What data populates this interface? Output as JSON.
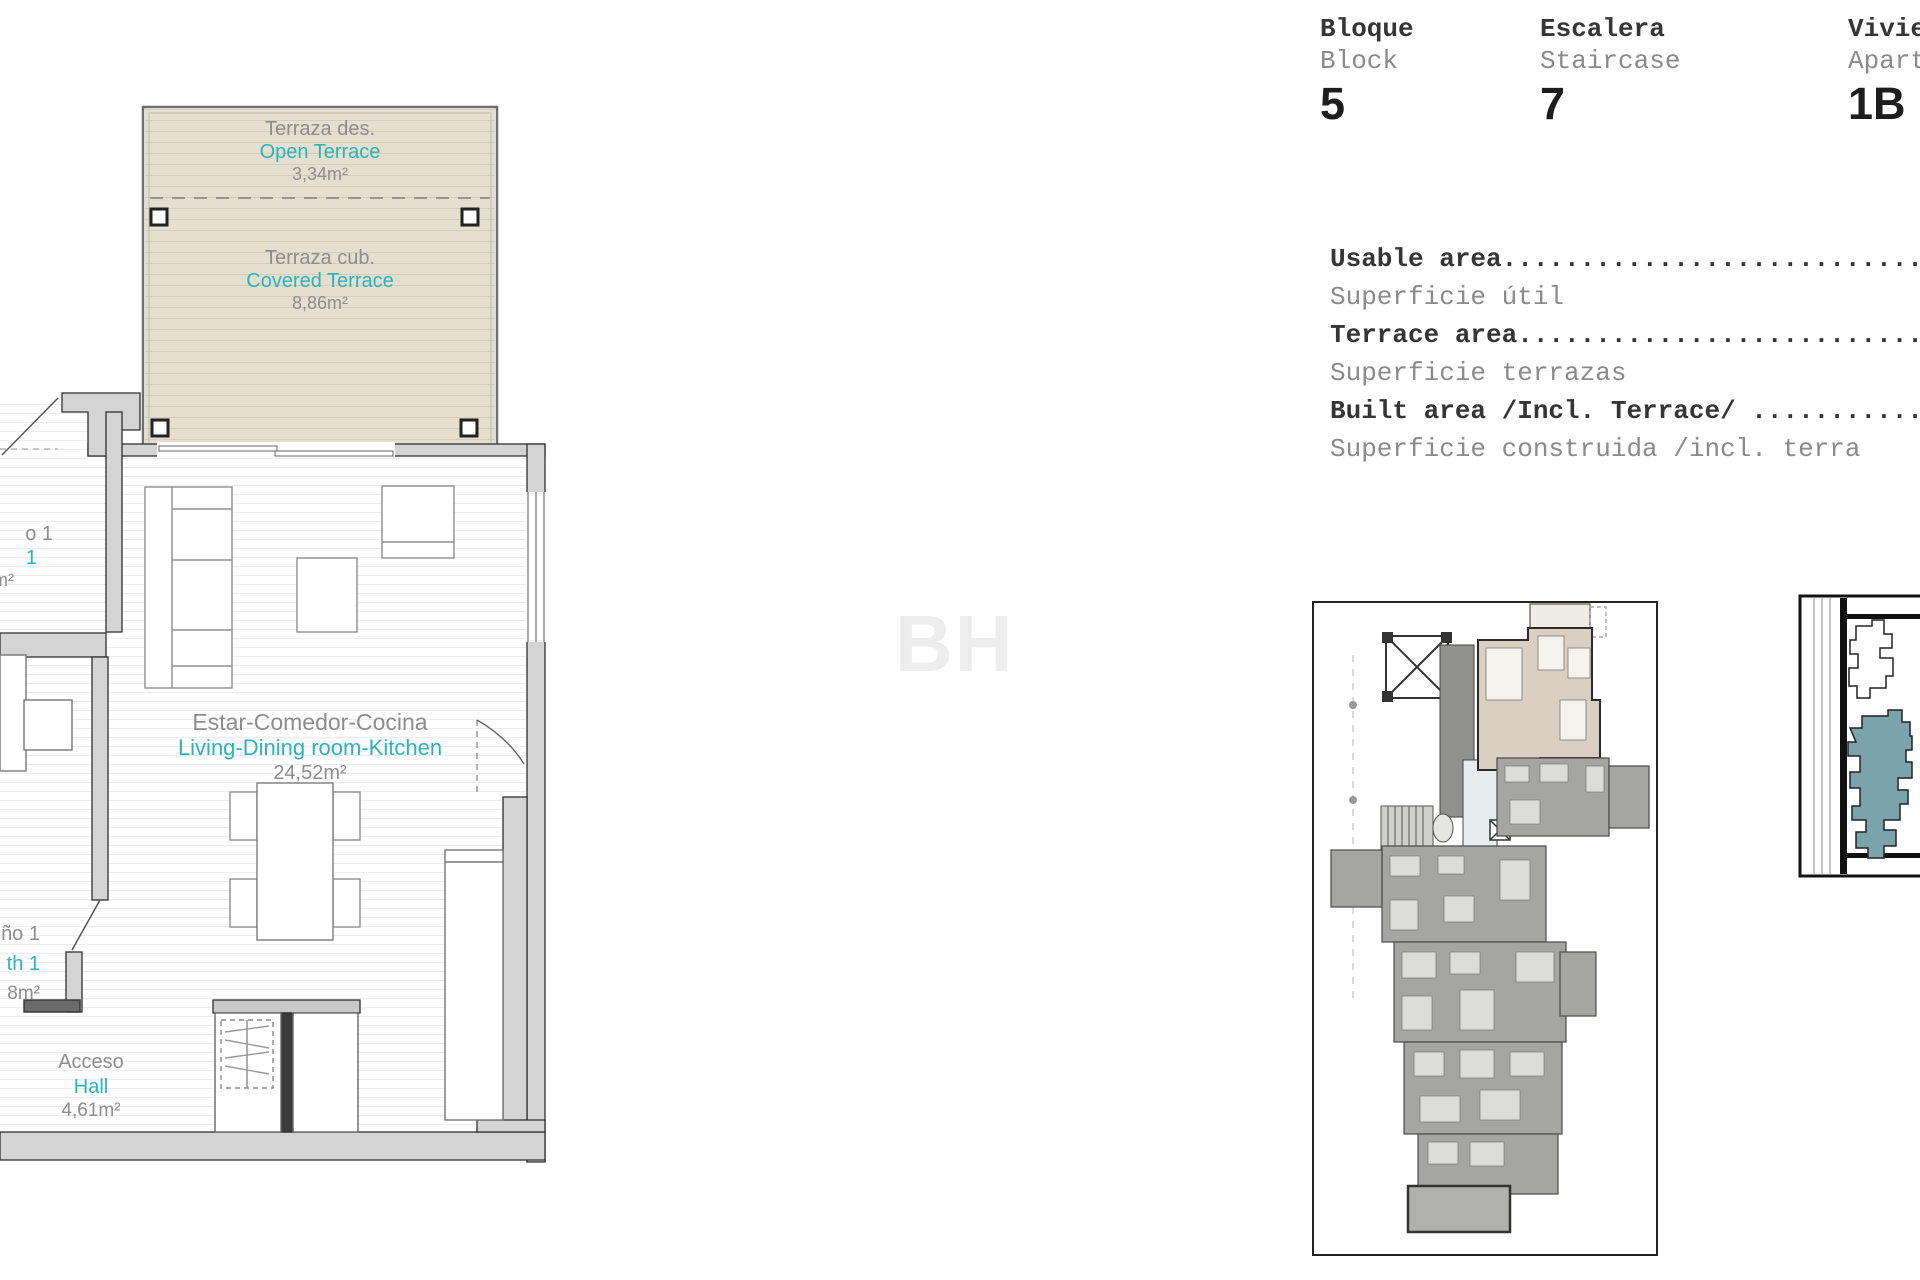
{
  "colors": {
    "teal": "#2bb3bc",
    "label_gray": "#8d8d8d",
    "terrace_fill": "#e5dfcf",
    "wall_fill": "#d4d4d4",
    "site_gray": "#a5a5a3",
    "unit_beige": "#dbcfc2",
    "keyplan_teal": "#7ba3ac"
  },
  "header": {
    "columns": [
      {
        "title_es": "Bloque",
        "title_en": "Block",
        "value": "5"
      },
      {
        "title_es": "Escalera",
        "title_en": "Staircase",
        "value": "7"
      },
      {
        "title_es": "Vivie",
        "title_en": "Apart",
        "value": "1B"
      }
    ]
  },
  "areas": {
    "rows": [
      {
        "en": "Usable area..................................",
        "es": "Superficie útil"
      },
      {
        "en": "Terrace area.................................",
        "es": "Superficie terrazas"
      },
      {
        "en": "Built area /Incl. Terrace/ ..................",
        "es": "Superficie construida /incl. terra"
      }
    ]
  },
  "plan": {
    "terrace_open": {
      "es": "Terraza des.",
      "en": "Open Terrace",
      "area": "3,34m²"
    },
    "terrace_covered": {
      "es": "Terraza cub.",
      "en": "Covered Terrace",
      "area": "8,86m²"
    },
    "living": {
      "es": "Estar-Comedor-Cocina",
      "en": "Living-Dining room-Kitchen",
      "area": "24,52m²"
    },
    "hall": {
      "es": "Acceso",
      "en": "Hall",
      "area": "4,61m²"
    },
    "bath_fragment": {
      "es": "ño 1",
      "en": "th 1",
      "area": "8m²"
    },
    "bedroom_fragment": {
      "es": "o 1",
      "en": "1",
      "area": "m²"
    }
  },
  "watermark": "BH"
}
